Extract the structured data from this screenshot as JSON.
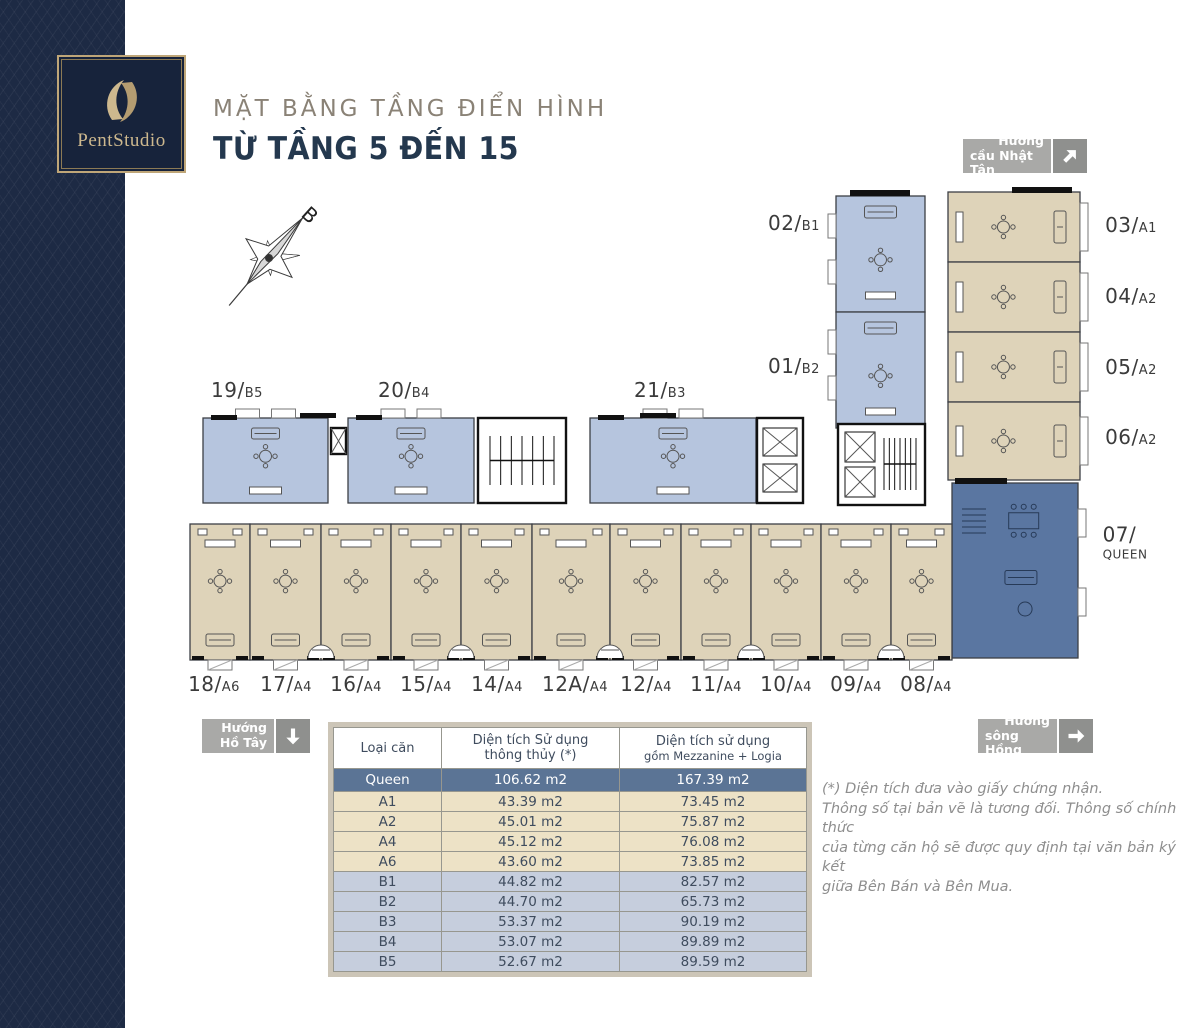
{
  "brand": {
    "logo_text": "PentStudio"
  },
  "header": {
    "title": "MẶT BẰNG TẦNG ĐIỂN HÌNH",
    "subtitle": "TỪ TẦNG 5 ĐẾN 15"
  },
  "compass": {
    "label": "B"
  },
  "directions": {
    "ne": {
      "line1": "Hướng",
      "line2": "cầu Nhật Tân",
      "arrow": "up-right"
    },
    "sw": {
      "line1": "Hướng",
      "line2": "Hồ Tây",
      "arrow": "down"
    },
    "se": {
      "line1": "Hướng",
      "line2": "sông Hồng",
      "arrow": "right"
    }
  },
  "colors": {
    "unit_blue": "#b6c5de",
    "unit_tan": "#ded3b9",
    "unit_queen": "#5a76a1",
    "wall": "#3c3f45",
    "furniture": "#555555",
    "furniture_queen": "#273a57"
  },
  "plan": {
    "units": [
      {
        "num": "19/",
        "type": "B5",
        "group": "b",
        "x": 203,
        "y": 418,
        "w": 125,
        "h": 85,
        "out": "N",
        "label": {
          "x": 237,
          "y": 390
        }
      },
      {
        "num": "20/",
        "type": "B4",
        "group": "b",
        "x": 348,
        "y": 418,
        "w": 126,
        "h": 85,
        "out": "N",
        "label": {
          "x": 404,
          "y": 390
        }
      },
      {
        "num": "21/",
        "type": "B3",
        "group": "b",
        "x": 590,
        "y": 418,
        "w": 166,
        "h": 85,
        "out": "N",
        "label": {
          "x": 660,
          "y": 390
        }
      },
      {
        "num": "02/",
        "type": "B1",
        "group": "b",
        "x": 836,
        "y": 196,
        "w": 89,
        "h": 116,
        "out": "W",
        "label": {
          "x": 794,
          "y": 223
        }
      },
      {
        "num": "01/",
        "type": "B2",
        "group": "b",
        "x": 836,
        "y": 312,
        "w": 89,
        "h": 116,
        "out": "W",
        "label": {
          "x": 794,
          "y": 366
        }
      },
      {
        "num": "03/",
        "type": "A1",
        "group": "a",
        "x": 948,
        "y": 192,
        "w": 132,
        "h": 70,
        "out": "E",
        "label": {
          "x": 1131,
          "y": 225
        }
      },
      {
        "num": "04/",
        "type": "A2",
        "group": "a",
        "x": 948,
        "y": 262,
        "w": 132,
        "h": 70,
        "out": "E",
        "label": {
          "x": 1131,
          "y": 296
        }
      },
      {
        "num": "05/",
        "type": "A2",
        "group": "a",
        "x": 948,
        "y": 332,
        "w": 132,
        "h": 70,
        "out": "E",
        "label": {
          "x": 1131,
          "y": 367
        }
      },
      {
        "num": "06/",
        "type": "A2",
        "group": "a",
        "x": 948,
        "y": 402,
        "w": 132,
        "h": 78,
        "out": "E",
        "label": {
          "x": 1131,
          "y": 437
        }
      },
      {
        "num": "07/",
        "type": "QUEEN",
        "group": "queen",
        "x": 952,
        "y": 483,
        "w": 126,
        "h": 175,
        "out": "E",
        "stacked": true,
        "label": {
          "x": 1125,
          "y": 542
        }
      },
      {
        "num": "18/",
        "type": "A6",
        "group": "a",
        "x": 190,
        "y": 524,
        "w": 60,
        "h": 136,
        "out": "S",
        "label": {
          "x": 214,
          "y": 684
        }
      },
      {
        "num": "17/",
        "type": "A4",
        "group": "a",
        "x": 250,
        "y": 524,
        "w": 71,
        "h": 136,
        "out": "S",
        "label": {
          "x": 286,
          "y": 684
        }
      },
      {
        "num": "16/",
        "type": "A4",
        "group": "a",
        "x": 321,
        "y": 524,
        "w": 70,
        "h": 136,
        "out": "S",
        "label": {
          "x": 356,
          "y": 684
        }
      },
      {
        "num": "15/",
        "type": "A4",
        "group": "a",
        "x": 391,
        "y": 524,
        "w": 70,
        "h": 136,
        "out": "S",
        "label": {
          "x": 426,
          "y": 684
        }
      },
      {
        "num": "14/",
        "type": "A4",
        "group": "a",
        "x": 461,
        "y": 524,
        "w": 71,
        "h": 136,
        "out": "S",
        "label": {
          "x": 497,
          "y": 684
        }
      },
      {
        "num": "12A/",
        "type": "A4",
        "group": "a",
        "x": 532,
        "y": 524,
        "w": 78,
        "h": 136,
        "out": "S",
        "label": {
          "x": 575,
          "y": 684
        }
      },
      {
        "num": "12/",
        "type": "A4",
        "group": "a",
        "x": 610,
        "y": 524,
        "w": 71,
        "h": 136,
        "out": "S",
        "label": {
          "x": 646,
          "y": 684
        }
      },
      {
        "num": "11/",
        "type": "A4",
        "group": "a",
        "x": 681,
        "y": 524,
        "w": 70,
        "h": 136,
        "out": "S",
        "label": {
          "x": 716,
          "y": 684
        }
      },
      {
        "num": "10/",
        "type": "A4",
        "group": "a",
        "x": 751,
        "y": 524,
        "w": 70,
        "h": 136,
        "out": "S",
        "label": {
          "x": 786,
          "y": 684
        }
      },
      {
        "num": "09/",
        "type": "A4",
        "group": "a",
        "x": 821,
        "y": 524,
        "w": 70,
        "h": 136,
        "out": "S",
        "label": {
          "x": 856,
          "y": 684
        }
      },
      {
        "num": "08/",
        "type": "A4",
        "group": "a",
        "x": 891,
        "y": 524,
        "w": 61,
        "h": 136,
        "out": "S",
        "label": {
          "x": 926,
          "y": 684
        }
      }
    ],
    "cores": [
      {
        "type": "stair",
        "x": 478,
        "y": 418,
        "w": 88,
        "h": 85
      },
      {
        "type": "lifts",
        "x": 757,
        "y": 418,
        "w": 46,
        "h": 85
      },
      {
        "type": "corelifts",
        "x": 838,
        "y": 424,
        "w": 87,
        "h": 81
      },
      {
        "type": "shaft",
        "x": 331,
        "y": 428,
        "w": 15,
        "h": 26
      }
    ],
    "stair_arc_x": [
      321,
      461,
      610,
      751,
      891
    ],
    "black_bars": [
      {
        "x": 850,
        "y": 190,
        "w": 60,
        "h": 6
      },
      {
        "x": 1012,
        "y": 187,
        "w": 60,
        "h": 6
      },
      {
        "x": 955,
        "y": 478,
        "w": 52,
        "h": 6
      },
      {
        "x": 300,
        "y": 413,
        "w": 36,
        "h": 5
      },
      {
        "x": 640,
        "y": 413,
        "w": 36,
        "h": 5
      }
    ]
  },
  "table": {
    "headers": [
      {
        "line1": "Loại căn",
        "line2": ""
      },
      {
        "line1": "Diện tích Sử dụng",
        "line2": "thông thủy (*)"
      },
      {
        "line1": "Diện tích sử dụng",
        "line2": "gồm Mezzanine + Logia"
      }
    ],
    "rows": [
      {
        "type": "Queen",
        "net": "106.62 m2",
        "gross": "167.39 m2",
        "group": "queen"
      },
      {
        "type": "A1",
        "net": "43.39 m2",
        "gross": "73.45 m2",
        "group": "a"
      },
      {
        "type": "A2",
        "net": "45.01 m2",
        "gross": "75.87 m2",
        "group": "a"
      },
      {
        "type": "A4",
        "net": "45.12 m2",
        "gross": "76.08 m2",
        "group": "a"
      },
      {
        "type": "A6",
        "net": "43.60 m2",
        "gross": "73.85 m2",
        "group": "a"
      },
      {
        "type": "B1",
        "net": "44.82 m2",
        "gross": "82.57 m2",
        "group": "b"
      },
      {
        "type": "B2",
        "net": "44.70 m2",
        "gross": "65.73 m2",
        "group": "b"
      },
      {
        "type": "B3",
        "net": "53.37 m2",
        "gross": "90.19 m2",
        "group": "b"
      },
      {
        "type": "B4",
        "net": "53.07 m2",
        "gross": "89.89 m2",
        "group": "b"
      },
      {
        "type": "B5",
        "net": "52.67 m2",
        "gross": "89.59 m2",
        "group": "b"
      }
    ]
  },
  "footnote": {
    "lines": [
      "(*) Diện tích đưa vào giấy chứng nhận.",
      "Thông số tại bản vẽ là tương đối. Thông số chính thức",
      "của từng căn hộ sẽ được quy định tại văn bản ký kết",
      "giữa Bên Bán và Bên Mua."
    ]
  }
}
